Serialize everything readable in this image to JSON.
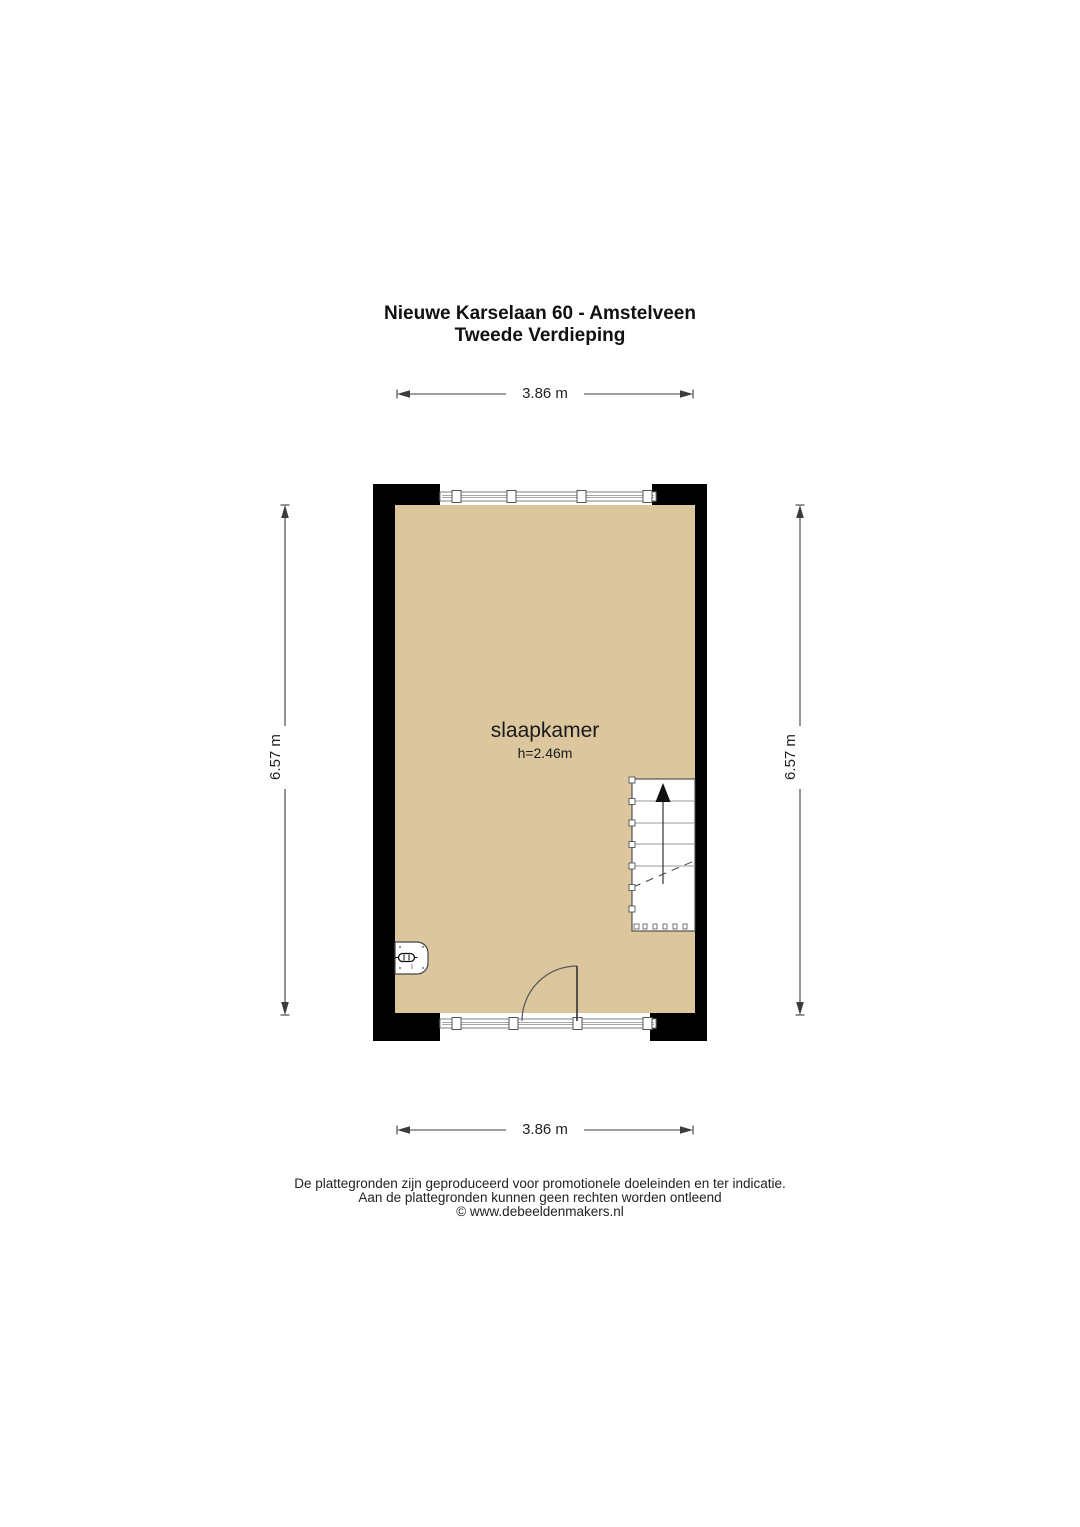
{
  "title": {
    "address": "Nieuwe Karselaan 60 - Amstelveen",
    "floor": "Tweede Verdieping"
  },
  "room": {
    "name": "slaapkamer",
    "ceiling_height": "h=2.46m"
  },
  "dimensions": {
    "top_width": "3.86 m",
    "bottom_width": "3.86 m",
    "left_height": "6.57 m",
    "right_height": "6.57 m"
  },
  "footer": {
    "line1": "De plattegronden zijn geproduceerd voor promotionele doeleinden en ter indicatie.",
    "line2": "Aan de plattegronden kunnen geen rechten worden ontleend",
    "line3": "© www.debeeldenmakers.nl"
  },
  "colors": {
    "floor_fill": "#dbc69e",
    "wall": "#000000",
    "dimension_line": "#3c3c3c",
    "window_line": "#808080"
  }
}
